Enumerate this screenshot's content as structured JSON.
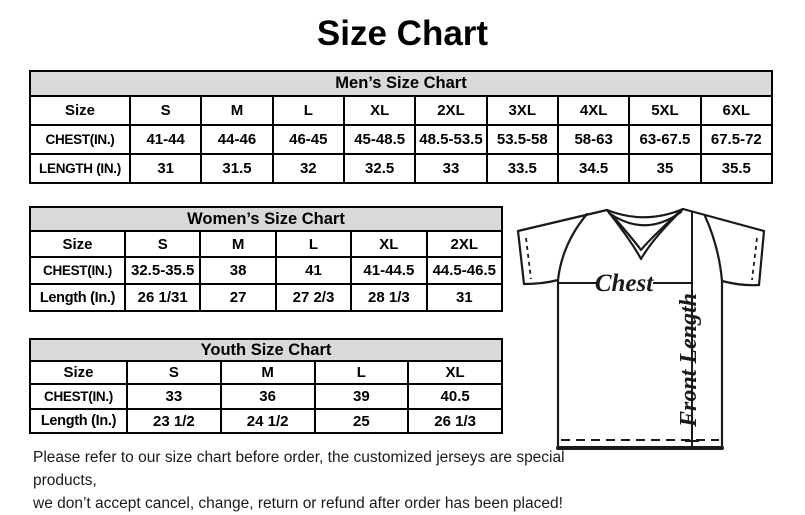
{
  "page": {
    "title": "Size Chart"
  },
  "colors": {
    "header_bg": "#d9d9d9",
    "border": "#000000",
    "text": "#000000",
    "background": "#ffffff"
  },
  "mens_table": {
    "title": "Men’s Size Chart",
    "header": [
      "Size",
      "S",
      "M",
      "L",
      "XL",
      "2XL",
      "3XL",
      "4XL",
      "5XL",
      "6XL"
    ],
    "chest": [
      "CHEST(IN.)",
      "41-44",
      "44-46",
      "46-45",
      "45-48.5",
      "48.5-53.5",
      "53.5-58",
      "58-63",
      "63-67.5",
      "67.5-72"
    ],
    "length": [
      "LENGTH (IN.)",
      "31",
      "31.5",
      "32",
      "32.5",
      "33",
      "33.5",
      "34.5",
      "35",
      "35.5"
    ]
  },
  "womens_table": {
    "title": "Women’s Size Chart",
    "header": [
      "Size",
      "S",
      "M",
      "L",
      "XL",
      "2XL"
    ],
    "chest": [
      "CHEST(IN.)",
      "32.5-35.5",
      "38",
      "41",
      "41-44.5",
      "44.5-46.5"
    ],
    "length": [
      "Length (In.)",
      "26 1/31",
      "27",
      "27 2/3",
      "28 1/3",
      "31"
    ]
  },
  "youth_table": {
    "title": "Youth Size Chart",
    "header": [
      "Size",
      "S",
      "M",
      "L",
      "XL"
    ],
    "chest": [
      "CHEST(IN.)",
      "33",
      "36",
      "39",
      "40.5"
    ],
    "length": [
      "Length (In.)",
      "23 1/2",
      "24 1/2",
      "25",
      "26 1/3"
    ]
  },
  "diagram": {
    "chest_label": "Chest",
    "front_length_label": "Front Length"
  },
  "footer": {
    "line1": "Please refer to our size chart before order, the customized jerseys are special products,",
    "line2": "we don’t accept cancel, change, return or refund after order has been placed!"
  }
}
